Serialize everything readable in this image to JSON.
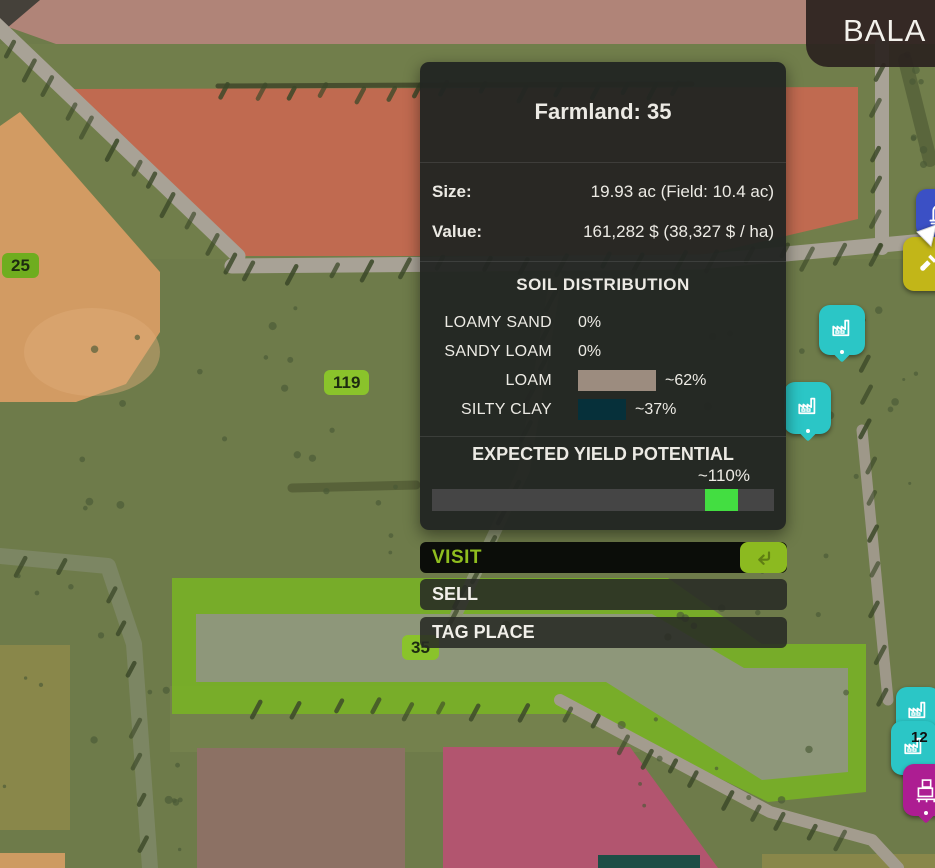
{
  "hud": {
    "map_name": "BALA"
  },
  "panel": {
    "title": "Farmland: 35",
    "stats": [
      {
        "label": "Size:",
        "value": "19.93 ac (Field: 10.4 ac)"
      },
      {
        "label": "Value:",
        "value": "161,282 $ (38,327 $ / ha)"
      }
    ],
    "soil": {
      "heading": "SOIL DISTRIBUTION",
      "rows": [
        {
          "label": "LOAMY SAND",
          "value": "0%",
          "bar_color": "",
          "bar_width": 0
        },
        {
          "label": "SANDY LOAM",
          "value": "0%",
          "bar_color": "",
          "bar_width": 0
        },
        {
          "label": "LOAM",
          "value": "~62%",
          "bar_color": "#9c8c7f",
          "bar_width": 78
        },
        {
          "label": "SILTY CLAY",
          "value": "~37%",
          "bar_color": "#06303a",
          "bar_width": 48
        }
      ]
    },
    "yield": {
      "heading": "EXPECTED YIELD POTENTIAL",
      "value": "~110%",
      "track_color": "#454545",
      "marker_color": "#43de41",
      "marker_left_pct": 79.9,
      "marker_width_pct": 9.6
    }
  },
  "actions": {
    "visit": "VISIT",
    "sell": "SELL",
    "tag": "TAG PLACE"
  },
  "map": {
    "labels": [
      {
        "text": "25"
      },
      {
        "text": "119"
      },
      {
        "text": "35"
      },
      {
        "text": "12"
      }
    ],
    "colors": {
      "grass": "#6e7b4a",
      "road": "#a8a296",
      "selection_green": "#79b523",
      "selected_field": "#8e977a",
      "badge_green": "#8ac32b"
    },
    "fields": [
      {
        "name": "field-rose-top",
        "color": "#b08478",
        "opacity": 1,
        "points": "0,0 935,0 935,44 56,44 0,24"
      },
      {
        "name": "corner-dark-wedge",
        "color": "#45413a",
        "opacity": 1,
        "points": "0,0 40,0 0,34"
      },
      {
        "name": "field-salmon",
        "color": "#c06a50",
        "opacity": 1,
        "points": "68,89 858,87 858,219 700,256 236,256"
      },
      {
        "name": "field-tan-left",
        "color": "#d29b63",
        "opacity": 1,
        "points": "0,126 20,112 160,272 160,332 126,384 76,402 0,402"
      },
      {
        "name": "selected-field-highlight",
        "color": "#79b523",
        "opacity": 0.85,
        "points": "172,578 668,578 762,644 866,644 866,792 768,802 588,714 172,714"
      },
      {
        "name": "selected-field-core",
        "color": "#8e977a",
        "opacity": 1,
        "points": "196,614 652,614 744,668 848,668 848,772 762,780 606,682 196,682"
      },
      {
        "name": "field-olive-left",
        "color": "#89874a",
        "opacity": 1,
        "points": "0,645 70,645 70,830 0,830"
      },
      {
        "name": "field-orange-strip",
        "color": "#cd9b62",
        "opacity": 1,
        "points": "0,853 65,853 65,868 0,868"
      },
      {
        "name": "field-brown-bottom",
        "color": "#8c7164",
        "opacity": 1,
        "points": "197,748 405,748 405,868 197,868"
      },
      {
        "name": "field-pink-bottom",
        "color": "#b2556f",
        "opacity": 1,
        "points": "443,747 630,747 718,868 443,868"
      },
      {
        "name": "field-olive-right",
        "color": "#89874a",
        "opacity": 1,
        "points": "762,854 935,854 935,868 762,868"
      },
      {
        "name": "field-teal-strip",
        "color": "#1d4e46",
        "opacity": 1,
        "points": "598,855 700,855 700,868 598,868"
      }
    ],
    "roads": [
      {
        "name": "road-topleft-diagonal",
        "color": "#a8a296",
        "width": 15,
        "path": "M-15,14 L238,256"
      },
      {
        "name": "road-horizontal",
        "color": "#a8a296",
        "width": 15,
        "path": "M232,266 L700,262 L935,240"
      },
      {
        "name": "road-right-vertical",
        "color": "#a8a296",
        "width": 14,
        "path": "M882,44 L882,248"
      },
      {
        "name": "path-center",
        "color": "#8d9574",
        "width": 12,
        "path": "M556,276 L524,470 L448,632"
      },
      {
        "name": "path-below-field",
        "color": "#a39c8e",
        "width": 12,
        "path": "M560,700 L770,812 L872,840 L898,868"
      },
      {
        "name": "path-left-stream",
        "color": "#7c8663",
        "width": 16,
        "path": "M0,556 L108,566 L134,644 L150,868"
      },
      {
        "name": "road-right-diagonal",
        "color": "#9e9889",
        "width": 11,
        "path": "M862,430 L888,700"
      }
    ],
    "icons": [
      {
        "name": "poi-factory-teal-1",
        "glyph": "factory",
        "color": "#2bc6c6",
        "x": 819,
        "y": 305,
        "w": 46,
        "h": 50,
        "tail": true
      },
      {
        "name": "poi-factory-teal-2",
        "glyph": "factory",
        "color": "#2bc6c6",
        "x": 784,
        "y": 382,
        "w": 47,
        "h": 52,
        "tail": true
      },
      {
        "name": "poi-monument-blue",
        "glyph": "monument",
        "color": "#3b50c5",
        "x": 916,
        "y": 189,
        "w": 44,
        "h": 48,
        "tail": false
      },
      {
        "name": "poi-tool-yellow",
        "glyph": "shovel",
        "color": "#c2b618",
        "x": 903,
        "y": 237,
        "w": 48,
        "h": 54,
        "tail": false
      },
      {
        "name": "poi-factory-teal-3",
        "glyph": "factory",
        "color": "#2bc6c6",
        "x": 896,
        "y": 687,
        "w": 44,
        "h": 50,
        "tail": true
      },
      {
        "name": "poi-factory-teal-4",
        "glyph": "factory",
        "color": "#2bc6c6",
        "x": 891,
        "y": 721,
        "w": 46,
        "h": 54,
        "tail": true
      },
      {
        "name": "poi-pallets-magenta",
        "glyph": "pallets",
        "color": "#ad1d92",
        "x": 903,
        "y": 764,
        "w": 46,
        "h": 52,
        "tail": true
      },
      {
        "name": "map-cursor",
        "glyph": "cursor",
        "color": "#ffffff",
        "x": 915,
        "y": 224,
        "w": 23,
        "h": 25,
        "tail": false
      }
    ]
  }
}
